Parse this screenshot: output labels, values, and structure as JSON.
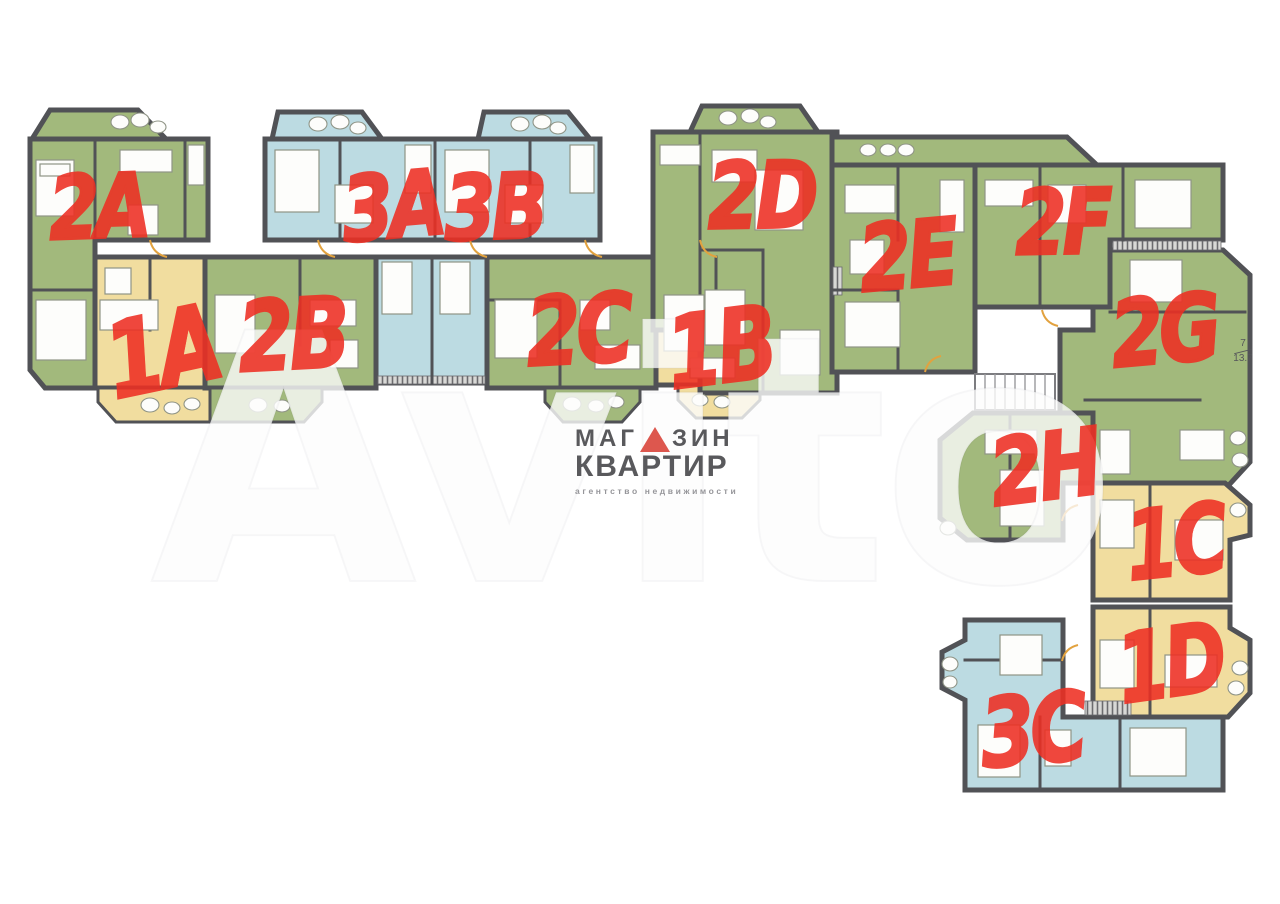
{
  "colors": {
    "green": "#a2b97c",
    "blue": "#bcdbe2",
    "yellow": "#f1dd9f",
    "wall": "#515256",
    "label_red": "#ee2f23"
  },
  "units": [
    {
      "id": "2A",
      "label": "2A",
      "type": "green"
    },
    {
      "id": "1A",
      "label": "1A",
      "type": "yellow"
    },
    {
      "id": "2B",
      "label": "2B",
      "type": "green"
    },
    {
      "id": "3A",
      "label": "3A",
      "type": "blue"
    },
    {
      "id": "3B",
      "label": "3B",
      "type": "blue"
    },
    {
      "id": "2C",
      "label": "2C",
      "type": "green"
    },
    {
      "id": "1B",
      "label": "1B",
      "type": "yellow"
    },
    {
      "id": "2D",
      "label": "2D",
      "type": "green"
    },
    {
      "id": "2E",
      "label": "2E",
      "type": "green"
    },
    {
      "id": "2F",
      "label": "2F",
      "type": "green"
    },
    {
      "id": "2G",
      "label": "2G",
      "type": "green"
    },
    {
      "id": "2H",
      "label": "2H",
      "type": "green"
    },
    {
      "id": "1C",
      "label": "1C",
      "type": "yellow"
    },
    {
      "id": "1D",
      "label": "1D",
      "type": "yellow"
    },
    {
      "id": "3C",
      "label": "3C",
      "type": "blue"
    }
  ],
  "room_annotation": {
    "room_number": "7",
    "area": "13.7"
  },
  "logo": {
    "word1_prefix": "МАГ",
    "word1_suffix": "ЗИН",
    "word2": "КВАРТИР",
    "tagline": "агентство недвижимости"
  },
  "watermark": {
    "text": "Avito"
  }
}
